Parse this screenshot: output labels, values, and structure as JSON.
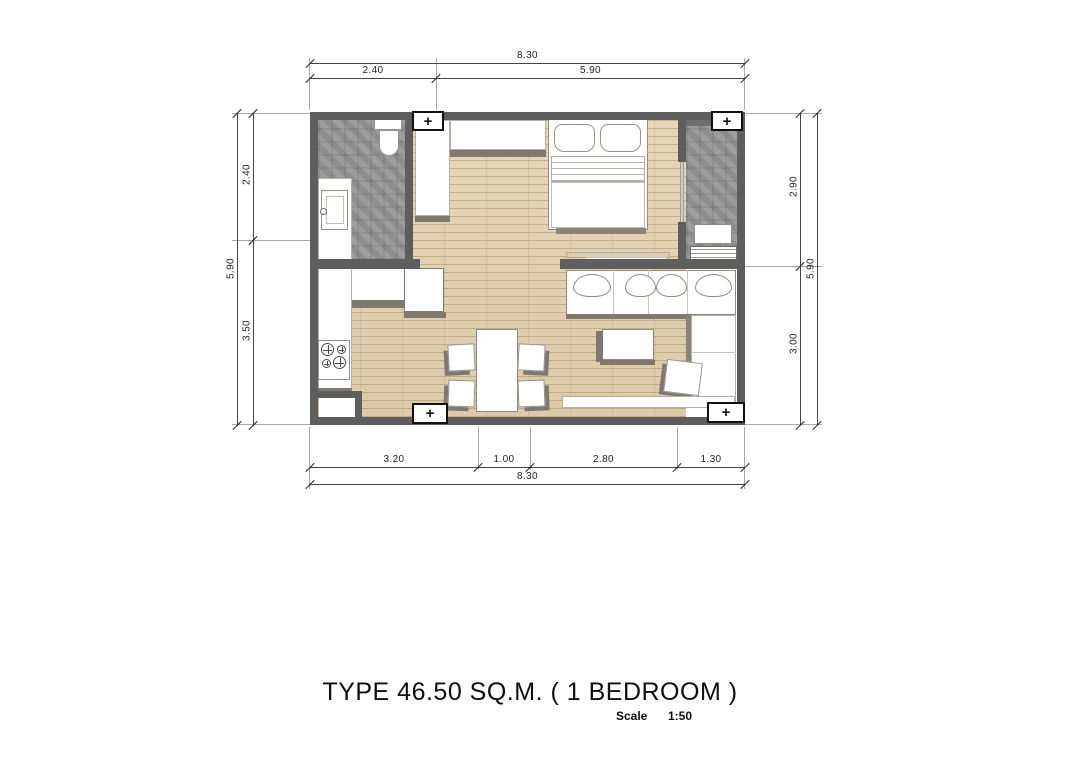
{
  "drawing": {
    "title": "TYPE 46.50 SQ.M. ( 1 BEDROOM )",
    "scale_label": "Scale",
    "scale_value": "1:50"
  },
  "dimensions": {
    "top_overall": "8.30",
    "top_segments": [
      "2.40",
      "5.90"
    ],
    "bottom_segments": [
      "3.20",
      "1.00",
      "2.80",
      "1.30"
    ],
    "bottom_overall": "8.30",
    "left_overall": "5.90",
    "left_segments": [
      "2.40",
      "3.50"
    ],
    "right_segments": [
      "2.90",
      "3.00"
    ],
    "right_overall": "5.90"
  },
  "markers": {
    "column_symbol": "+"
  },
  "colors": {
    "wall": "#5e5e5e",
    "wood_floor": "#e2d2b4",
    "tile_floor": "#979797",
    "furniture": "#ffffff",
    "shadow": "#7e786f",
    "dimension_line": "#444444",
    "text": "#111111"
  }
}
